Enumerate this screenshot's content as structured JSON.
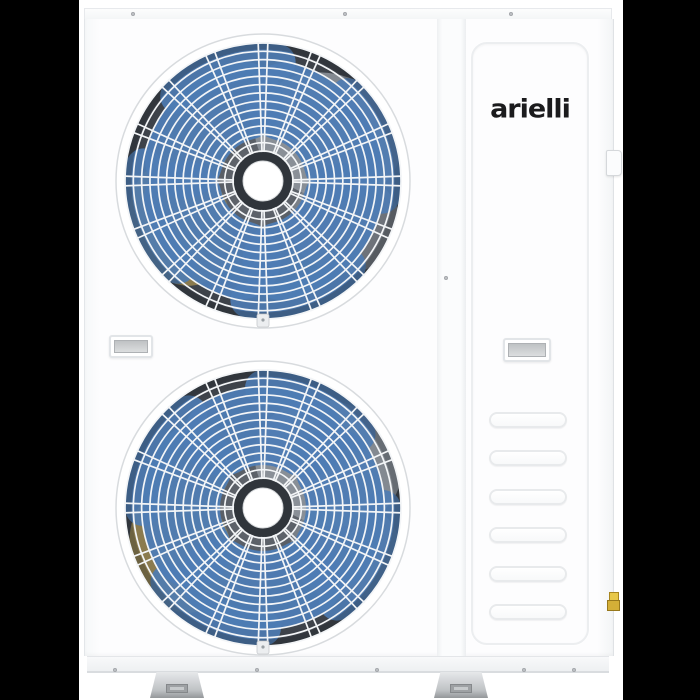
{
  "scene": {
    "background": "#ffffff",
    "pillarbox_color": "#000000"
  },
  "brand": {
    "logo_text": "arielli",
    "logo_color": "#1b1b1d"
  },
  "palette": {
    "body_white": "#fdfdfe",
    "edge_gray": "#e3e6e9",
    "seam_gray": "#e8eaec",
    "fan_base_light": "#6a6f76",
    "fan_base_mid": "#4d525a",
    "fan_base_dark": "#3a3f46",
    "blade_blue": "#4e7cb4",
    "blade_olive": "#94824f",
    "blade_gray": "#959ba2",
    "grille_line": "#f3f5f7",
    "hub_white": "#ffffff",
    "hub_ring_dark": "#30353b",
    "metal_foot": "#c4c7ca",
    "valve_gold": "#d4af37"
  },
  "fans": {
    "count": 2,
    "rings": 14,
    "spoke_pairs": 16,
    "blades": 4,
    "rotations": [
      15,
      60
    ]
  },
  "vents": {
    "count": 6
  },
  "feet": {
    "count": 2
  },
  "screws": {
    "top_count": 3,
    "side_count": 1,
    "base_count": 5
  }
}
